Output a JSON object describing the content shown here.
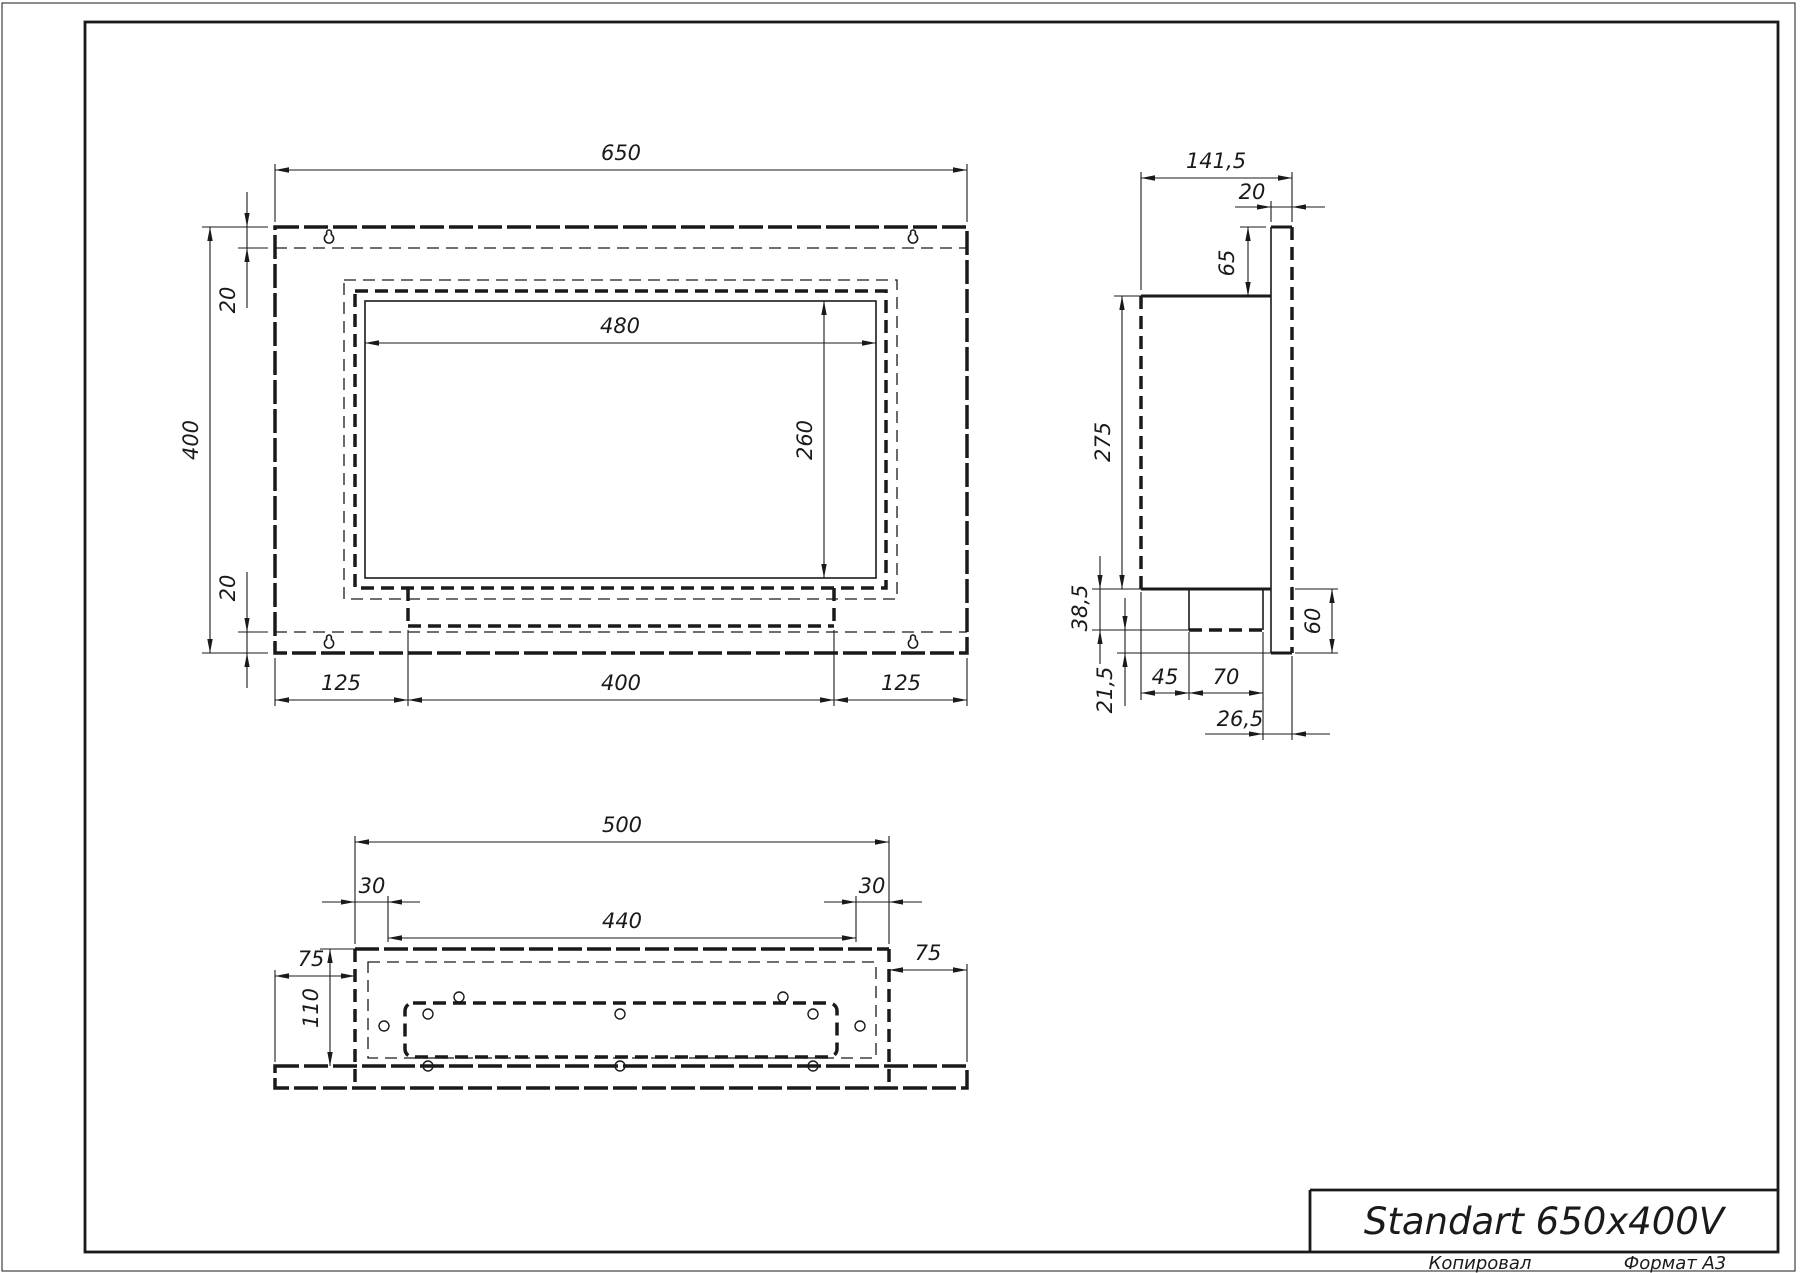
{
  "title_block": {
    "title": "Standart 650x400V"
  },
  "sheet": {
    "copied_label": "Копировал",
    "format_label": "Формат А3"
  },
  "front_view": {
    "width": "650",
    "height": "400",
    "top_inset": "20",
    "bottom_inset": "20",
    "opening_width": "480",
    "opening_height": "260",
    "left_offset": "125",
    "tray_width": "400",
    "right_offset": "125"
  },
  "side_view": {
    "depth": "141,5",
    "flange_thickness": "20",
    "top_offset": "65",
    "body_height": "275",
    "tray_drop": "38,5",
    "flange_bottom_drop": "21,5",
    "tray_left_offset": "45",
    "tray_depth": "70",
    "tray_right_offset": "26,5",
    "bottom_height": "60"
  },
  "bottom_view": {
    "body_width": "500",
    "left_inset": "30",
    "inner_width": "440",
    "right_inset": "30",
    "left_overhang": "75",
    "depth": "110",
    "right_overhang": "75"
  },
  "colors": {
    "line": "#1a1a1a",
    "background": "#ffffff"
  }
}
